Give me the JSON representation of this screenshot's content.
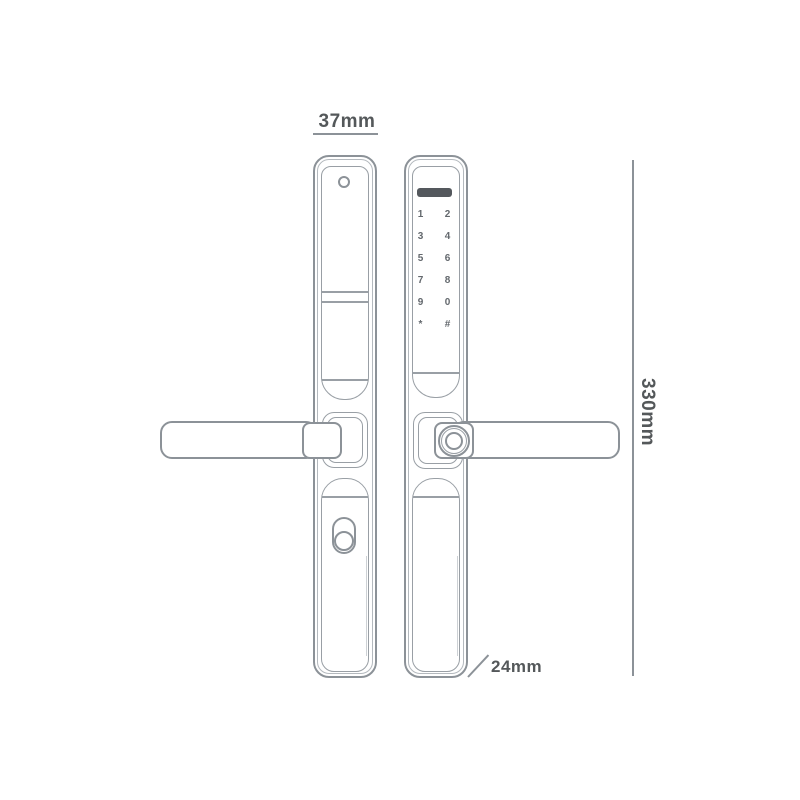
{
  "title": "Smart door lock dimension diagram",
  "colors": {
    "background": "#ffffff",
    "outline": "#8c9298",
    "outline_light": "#b4b9be",
    "panel": "#999fa5",
    "display_bar": "#54585d",
    "keypad_text": "#63686d",
    "dimension_text": "#54585a",
    "dimension_line": "#8c9298",
    "side_shade": "#cdd1d5"
  },
  "dimensions": {
    "width": {
      "label": "37mm"
    },
    "height": {
      "label": "330mm"
    },
    "depth": {
      "label": "24mm"
    }
  },
  "front_plate": {
    "keypad_keys": [
      "1",
      "2",
      "3",
      "4",
      "5",
      "6",
      "7",
      "8",
      "9",
      "0",
      "*",
      "#"
    ]
  }
}
